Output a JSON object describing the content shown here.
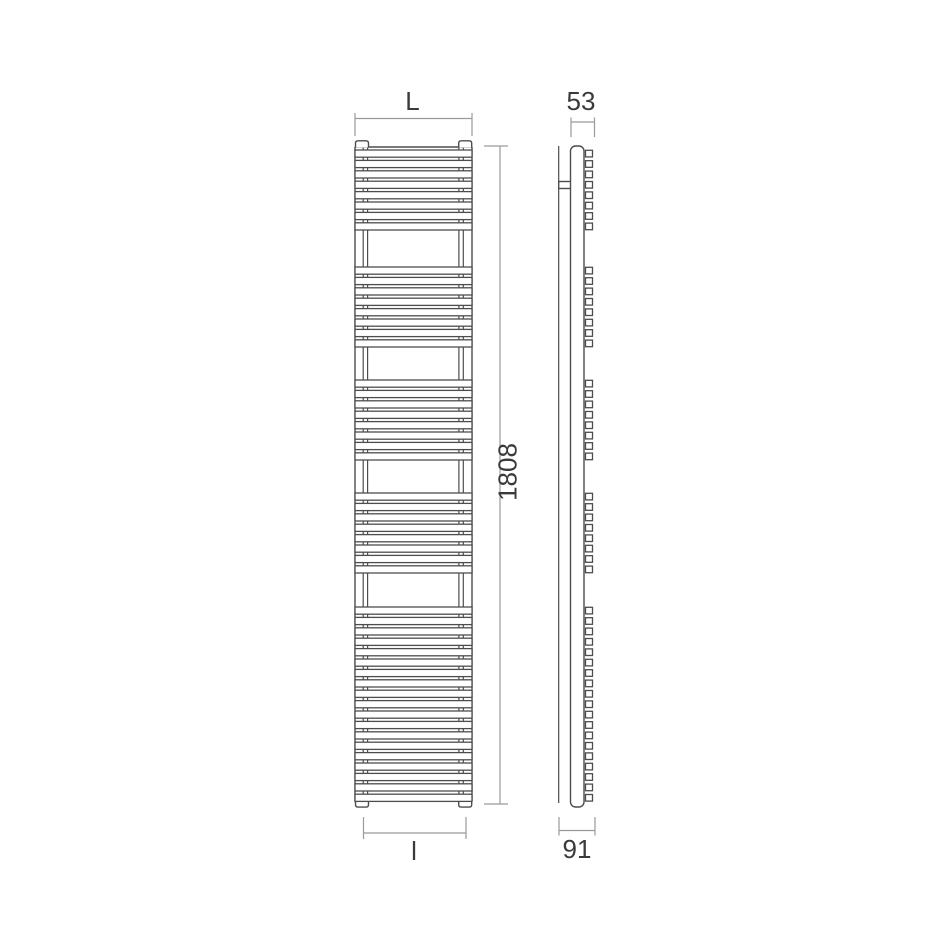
{
  "colors": {
    "background": "#ffffff",
    "drawing_line": "#4d4d4d",
    "dimension_line": "#9a9a9a",
    "text": "#3a3a3a"
  },
  "dimension_labels": {
    "overall_width_top": "L",
    "depth_top": "53",
    "overall_height": "1808",
    "connection_width_bottom": "l",
    "depth_bottom": "91"
  },
  "figure": {
    "type": "towel-radiator technical drawing, front view and side view",
    "front_view": {
      "left": 355,
      "right": 472,
      "top": 147,
      "bottom": 801,
      "tube_groups": [
        8,
        8,
        8,
        8,
        19
      ],
      "group_start_y": [
        150,
        267,
        380,
        493,
        607
      ],
      "tube_pitch": 10.4,
      "tube_height": 7.2
    },
    "side_view": {
      "square_x": 585.5,
      "square_width": 7
    }
  }
}
